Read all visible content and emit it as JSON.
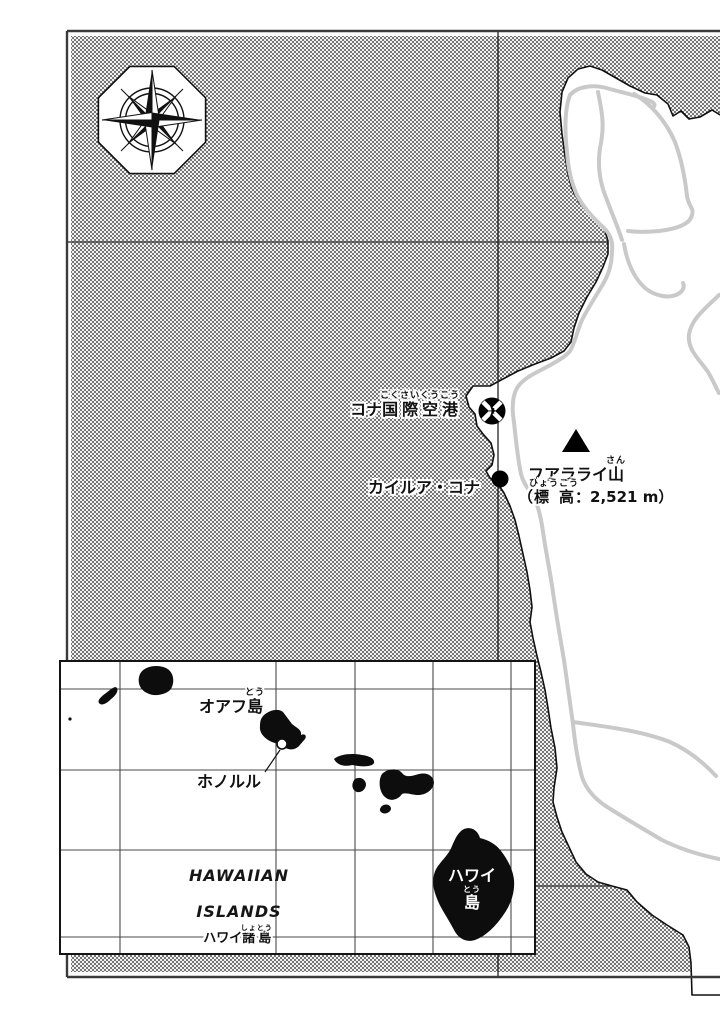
{
  "main_map": {
    "airport_label": {
      "pre": "コナ",
      "kanji": "国際空港",
      "furigana": "こくさいくうこう"
    },
    "city_label": "カイルア・コナ",
    "mountain_label": {
      "pre": "フアラライ",
      "kanji": "山",
      "furigana": "さん"
    },
    "elevation_label": {
      "open": "（",
      "kanji": "標高",
      "furigana": "ひょうこう",
      "rest": "：2,521 m）"
    }
  },
  "inset_map": {
    "oahu_label": {
      "pre": "オアフ",
      "kanji": "島",
      "furigana": "とう"
    },
    "honolulu_label": "ホノルル",
    "hawaii_island_label": {
      "line1": "ハワイ",
      "kanji": "島",
      "furigana": "とう"
    },
    "title": {
      "line1": "HAWAIIAN",
      "line2": "ISLANDS"
    },
    "subtitle": {
      "pre": "ハワイ",
      "kanji": "諸島",
      "furigana": "しょとう"
    }
  },
  "icons": [
    "compass-rose-icon",
    "airport-icon",
    "city-dot-icon",
    "mountain-triangle-icon"
  ],
  "colors": {
    "ink": "#111111",
    "ocean_dot": "#4d4d4d",
    "ocean_bg": "#f1f1f1",
    "land": "#ffffff",
    "road": "#c9c9c9",
    "frame": "#3a3a3a"
  }
}
